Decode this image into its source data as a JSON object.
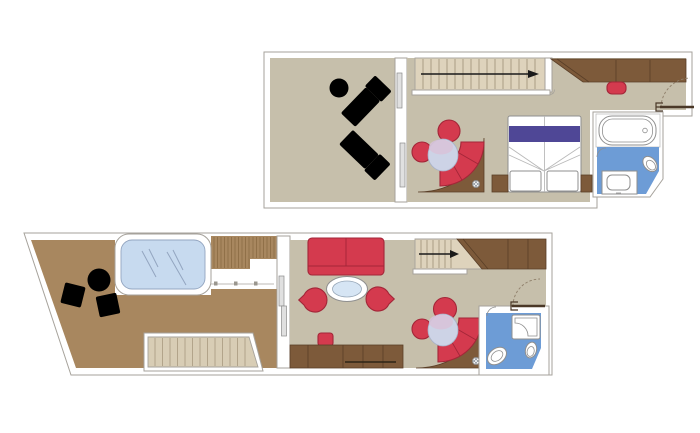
{
  "meta": {
    "title": "Duplex suite floor plan",
    "canvas_width": 700,
    "canvas_height": 433
  },
  "colors": {
    "wall_line": "#a6a29b",
    "floor": "#c6bfab",
    "deck": "#a8875f",
    "deck_line": "#8a6b44",
    "wood_dark": "#7d5a3a",
    "wood_dark_line": "#5a3f28",
    "red": "#d43a4e",
    "red_line": "#a32638",
    "purple": "#4f4796",
    "stair": "#ded3bc",
    "stair_line": "#9c8f77",
    "stair_outdoor": "#d8cdb5",
    "stair_outdoor_line": "#a89a7f",
    "bath_blue": "#6d9cd6",
    "fixture_line": "#8f8f8f",
    "hot_tub_water": "#c7daef",
    "hot_tub_line": "#93a5c0",
    "glass_table": "#d6e5f4",
    "pouf": "#cdd3e6",
    "pouf_highlight": "#d8c2d8",
    "door_leaf": "#4a3827",
    "arrow": "#1a1a1a",
    "panel": "#e0e0e0"
  },
  "plans": [
    {
      "id": "upper-floor",
      "areas": [
        {
          "name": "balcony",
          "furniture": [
            "round-table",
            "sun-lounger",
            "sun-lounger"
          ],
          "features": [
            "sliding-glass-door"
          ]
        },
        {
          "name": "living-area",
          "furniture": [
            "curved-sofa",
            "round-armchair",
            "round-armchair",
            "pouf"
          ],
          "features": [
            "staircase-with-arrow",
            "railing"
          ]
        },
        {
          "name": "bedroom",
          "furniture": [
            "double-bed",
            "nightstand",
            "nightstand",
            "wardrobe",
            "stool"
          ],
          "features": [
            "entry-door"
          ]
        },
        {
          "name": "bathroom",
          "furniture": [
            "bathtub",
            "washbasin",
            "toilet"
          ],
          "features": [
            "door"
          ]
        }
      ]
    },
    {
      "id": "lower-floor",
      "areas": [
        {
          "name": "terrace",
          "furniture": [
            "whirlpool",
            "round-table",
            "outdoor-chair",
            "outdoor-chair"
          ],
          "features": [
            "slatted-deck",
            "railing",
            "outdoor-staircase"
          ]
        },
        {
          "name": "living-room",
          "furniture": [
            "sofa",
            "oval-glass-table",
            "tub-chair",
            "tub-chair",
            "stool",
            "desk",
            "curved-sofa",
            "round-armchair",
            "round-armchair",
            "pouf",
            "wardrobe"
          ],
          "features": [
            "staircase-with-arrow",
            "railing",
            "sliding-glass-door",
            "entry-door"
          ]
        },
        {
          "name": "bathroom",
          "furniture": [
            "shower",
            "washbasin",
            "toilet"
          ],
          "features": [
            "door"
          ]
        }
      ]
    }
  ]
}
